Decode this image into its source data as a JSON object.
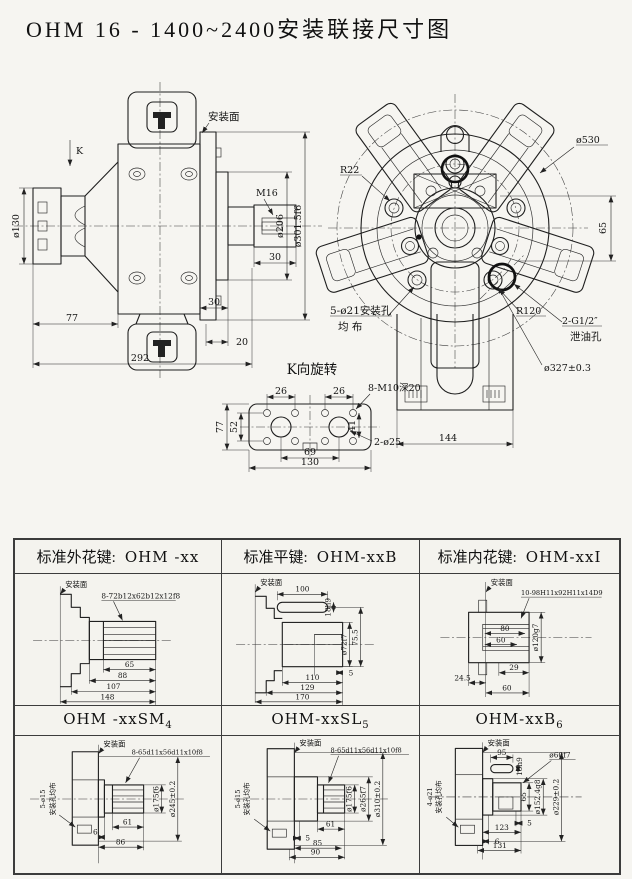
{
  "title": "OHM 16 - 1400~2400安装联接尺寸图",
  "side_view": {
    "k_label": "K",
    "mount_face_label": "安装面",
    "dims": {
      "dia130": "ø130",
      "m16": "M16",
      "dia206": "ø206",
      "dia301": "ø301.5f6",
      "shaft_len30": "30",
      "flange30": "30",
      "port20": "20",
      "len77": "77",
      "len292": "292"
    }
  },
  "front_view": {
    "dims": {
      "r22": "R22",
      "dia530": "ø530",
      "h65": "65",
      "holes_line1": "5-ø21安装孔",
      "holes_line2": "均 布",
      "r120": "R120",
      "drain_line1": "2-G1/2″",
      "drain_line2": "泄油孔",
      "dia327": "ø327±0.3",
      "w144": "144"
    }
  },
  "k_view": {
    "title": "K向旋转",
    "dims": {
      "w26a": "26",
      "w26b": "26",
      "holes8": "8-M10深20",
      "h41": "41",
      "h52": "52",
      "h77": "77",
      "holes2": "2-ø25",
      "w69": "69",
      "w130": "130"
    }
  },
  "table": {
    "row1": [
      {
        "type_label": "标准外花键:",
        "model": "OHM -xx",
        "mount_face": "安装面",
        "spline": "8-72b12x62b12x12f8",
        "d1": "65",
        "d2": "88",
        "d3": "107",
        "d4": "148"
      },
      {
        "type_label": "标准平键:",
        "model": "OHM-xxB",
        "mount_face": "安装面",
        "key_len": "100",
        "key_size": "18h9",
        "shaft_dia": "ø72f7",
        "key_h": "75.5",
        "d5": "5",
        "d1": "110",
        "d2": "129",
        "d3": "170"
      },
      {
        "type_label": "标准内花键:",
        "model": "OHM-xxI",
        "mount_face": "安装面",
        "spline": "10-98H11x92H11x14D9",
        "bore80": "80",
        "bore60": "60",
        "dia": "ø120g7",
        "d29": "29",
        "d245": "24.5",
        "d60": "60"
      }
    ],
    "row2": [
      {
        "model": "OHM -xxSM",
        "sub": "4",
        "mount_face": "安装面",
        "spline": "8-65d11x56d11x10f8",
        "holes1": "5-ø15",
        "holes2": "安装孔均布",
        "dia1": "ø175f6",
        "dia2": "ø245±0.2",
        "d1": "61",
        "d2": "6",
        "d3": "86"
      },
      {
        "model": "OHM-xxSL",
        "sub": "5",
        "mount_face": "安装面",
        "spline": "8-65d11x56d11x10f8",
        "holes1": "5-ø15",
        "holes2": "安装孔均布",
        "dia1": "ø175f6",
        "dia2": "ø265f7",
        "dia3": "ø310±0.2",
        "d1": "61",
        "d2": "5",
        "d3": "85",
        "d4": "90"
      },
      {
        "model": "OHM-xxB",
        "sub": "6",
        "mount_face": "安装面",
        "key_size": "18h9",
        "key_len": "95",
        "shaft_dia": "ø60f7",
        "d65": "65",
        "dia1": "ø152.4g8",
        "dia2": "ø229±0.2",
        "holes1": "4-ø21",
        "holes2": "安装孔均布",
        "d5": "5",
        "d1": "123",
        "d2": "6",
        "d3": "131"
      }
    ]
  }
}
